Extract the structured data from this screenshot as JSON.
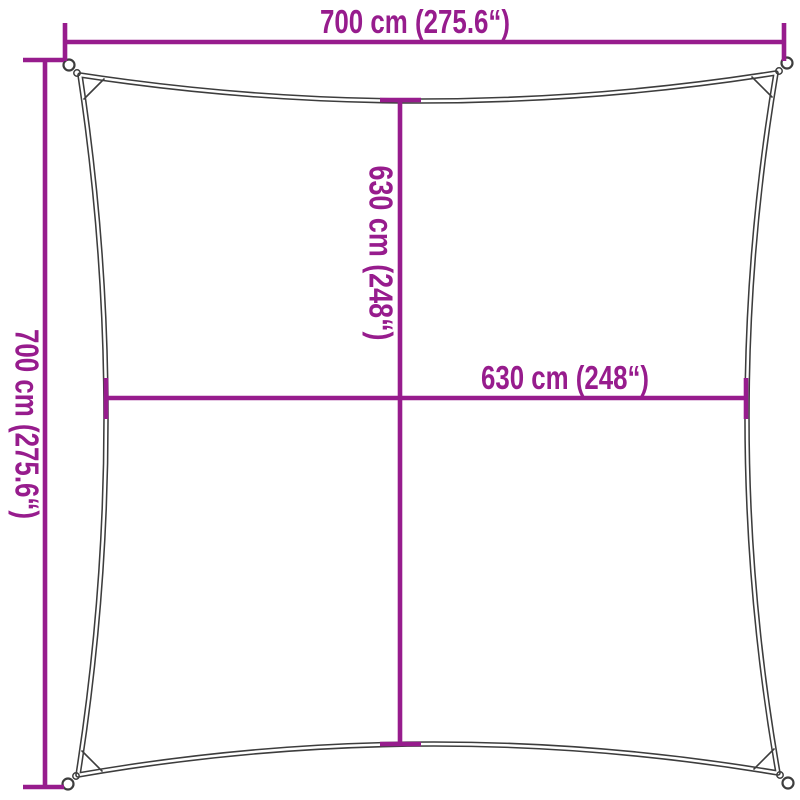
{
  "colors": {
    "dimension": "#971c8d",
    "outline": "#3d3d3d",
    "background": "#ffffff"
  },
  "diagram": {
    "name": "square-shade-sail-dimension-diagram",
    "labels": {
      "top_width": "700 cm (275.6“)",
      "left_height": "700 cm (275.6“)",
      "inner_height": "630 cm (248“)",
      "inner_width": "630 cm (248“)"
    }
  }
}
